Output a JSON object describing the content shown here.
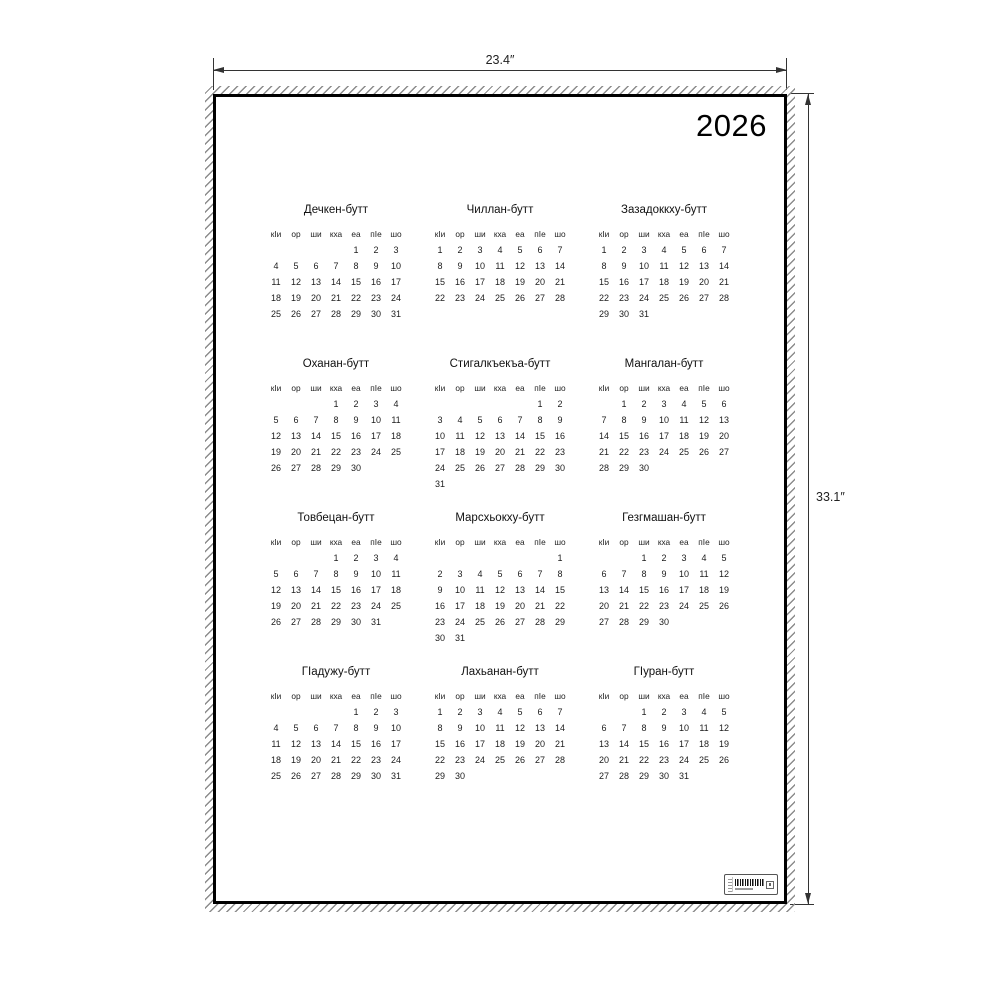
{
  "annotations": {
    "width_label": "23.4″",
    "height_label": "33.1″"
  },
  "poster": {
    "year": "2026",
    "weekday_headers": [
      "кIи",
      "ор",
      "ши",
      "кха",
      "еа",
      "пIе",
      "шо"
    ],
    "months": [
      {
        "name": "Дечкен-бутт",
        "first_day_col": 4,
        "num_days": 31
      },
      {
        "name": "Чиллан-бутт",
        "first_day_col": 0,
        "num_days": 28
      },
      {
        "name": "Зазадоккху-бутт",
        "first_day_col": 0,
        "num_days": 31
      },
      {
        "name": "Оханан-бутт",
        "first_day_col": 3,
        "num_days": 30
      },
      {
        "name": "Стигалкъекъа-бутт",
        "first_day_col": 5,
        "num_days": 31
      },
      {
        "name": "Мангалан-бутт",
        "first_day_col": 1,
        "num_days": 30
      },
      {
        "name": "Товбецан-бутт",
        "first_day_col": 3,
        "num_days": 31
      },
      {
        "name": "Марсхьокху-бутт",
        "first_day_col": 6,
        "num_days": 31
      },
      {
        "name": "Гезгмашан-бутт",
        "first_day_col": 2,
        "num_days": 30
      },
      {
        "name": "ГIадужу-бутт",
        "first_day_col": 4,
        "num_days": 31
      },
      {
        "name": "Лахьанан-бутт",
        "first_day_col": 0,
        "num_days": 30
      },
      {
        "name": "ГIуран-бутт",
        "first_day_col": 2,
        "num_days": 31
      }
    ],
    "barcode_label": {
      "present": true
    }
  },
  "colors": {
    "background": "#ffffff",
    "frame": "#000000",
    "hatch": "#8c8c8c",
    "dimension": "#333333",
    "text": "#1c1c1c"
  }
}
